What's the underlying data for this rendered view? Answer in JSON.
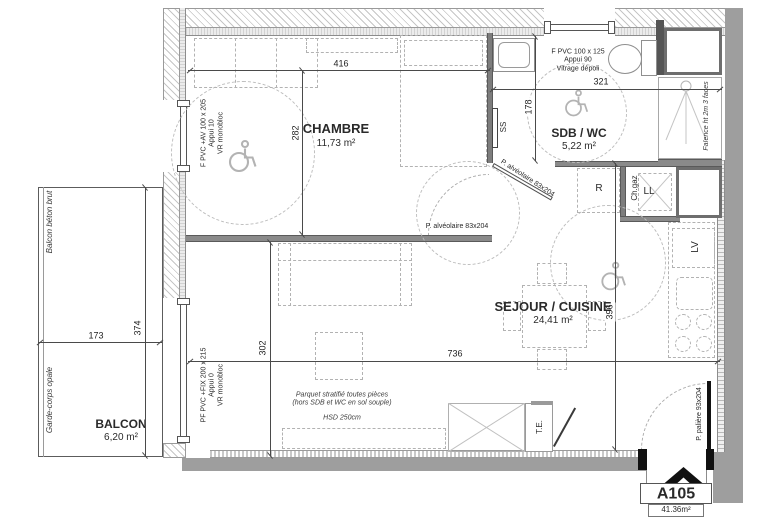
{
  "unit": {
    "number": "A105",
    "area": "41.36m²"
  },
  "rooms": {
    "chambre": {
      "name": "CHAMBRE",
      "area": "11,73 m²"
    },
    "sdb": {
      "name": "SDB / WC",
      "area": "5,22 m²"
    },
    "sejour": {
      "name": "SEJOUR / CUISINE",
      "area": "24,41 m²"
    },
    "balcon": {
      "name": "BALCON",
      "area": "6,20 m²"
    }
  },
  "dims": {
    "chambre_w": "416",
    "chambre_h": "282",
    "sdb_w": "321",
    "sdb_h": "178",
    "sejour_w": "736",
    "sejour_h": "396",
    "sejour_h2": "302",
    "balcon_w": "173",
    "balcon_h": "374"
  },
  "windows": {
    "chambre": {
      "lines": [
        "F PVC +AV  100 x 205",
        "Appui  10",
        "VR  monobloc"
      ]
    },
    "sejour": {
      "lines": [
        "PF PVC +FIX  200 x 215",
        "Appui  0",
        "VR  monobloc"
      ]
    },
    "sdb": {
      "lines": [
        "F PVC  100 x 125",
        "Appui  90",
        "Vitrage  dépoli"
      ]
    }
  },
  "doors": {
    "chambre": "P. alvéolaire 83x204",
    "sdb": "P. alvéolaire 83x204",
    "entry": "P. palière  93x204"
  },
  "notes": {
    "balcon_floor": "Balcon béton brut",
    "railing": "Garde-corps opale",
    "tiling": "Faïence ht 2m 3 faces",
    "floor": {
      "lines": [
        "Parquet stratifié toutes pièces",
        "(hors SDB et WC en sol souple)",
        "HSD 250cm"
      ]
    }
  },
  "equipment": {
    "towel_rail": "SS",
    "fridge": "R",
    "boiler": "Ch.gaz",
    "washer": "LL",
    "dishwasher": "LV",
    "panel": "T.E."
  },
  "colors": {
    "wall": "#9e9e9e",
    "partition": "#8a8a8a",
    "dark": "#555555",
    "dash": "#b2b2b2"
  }
}
